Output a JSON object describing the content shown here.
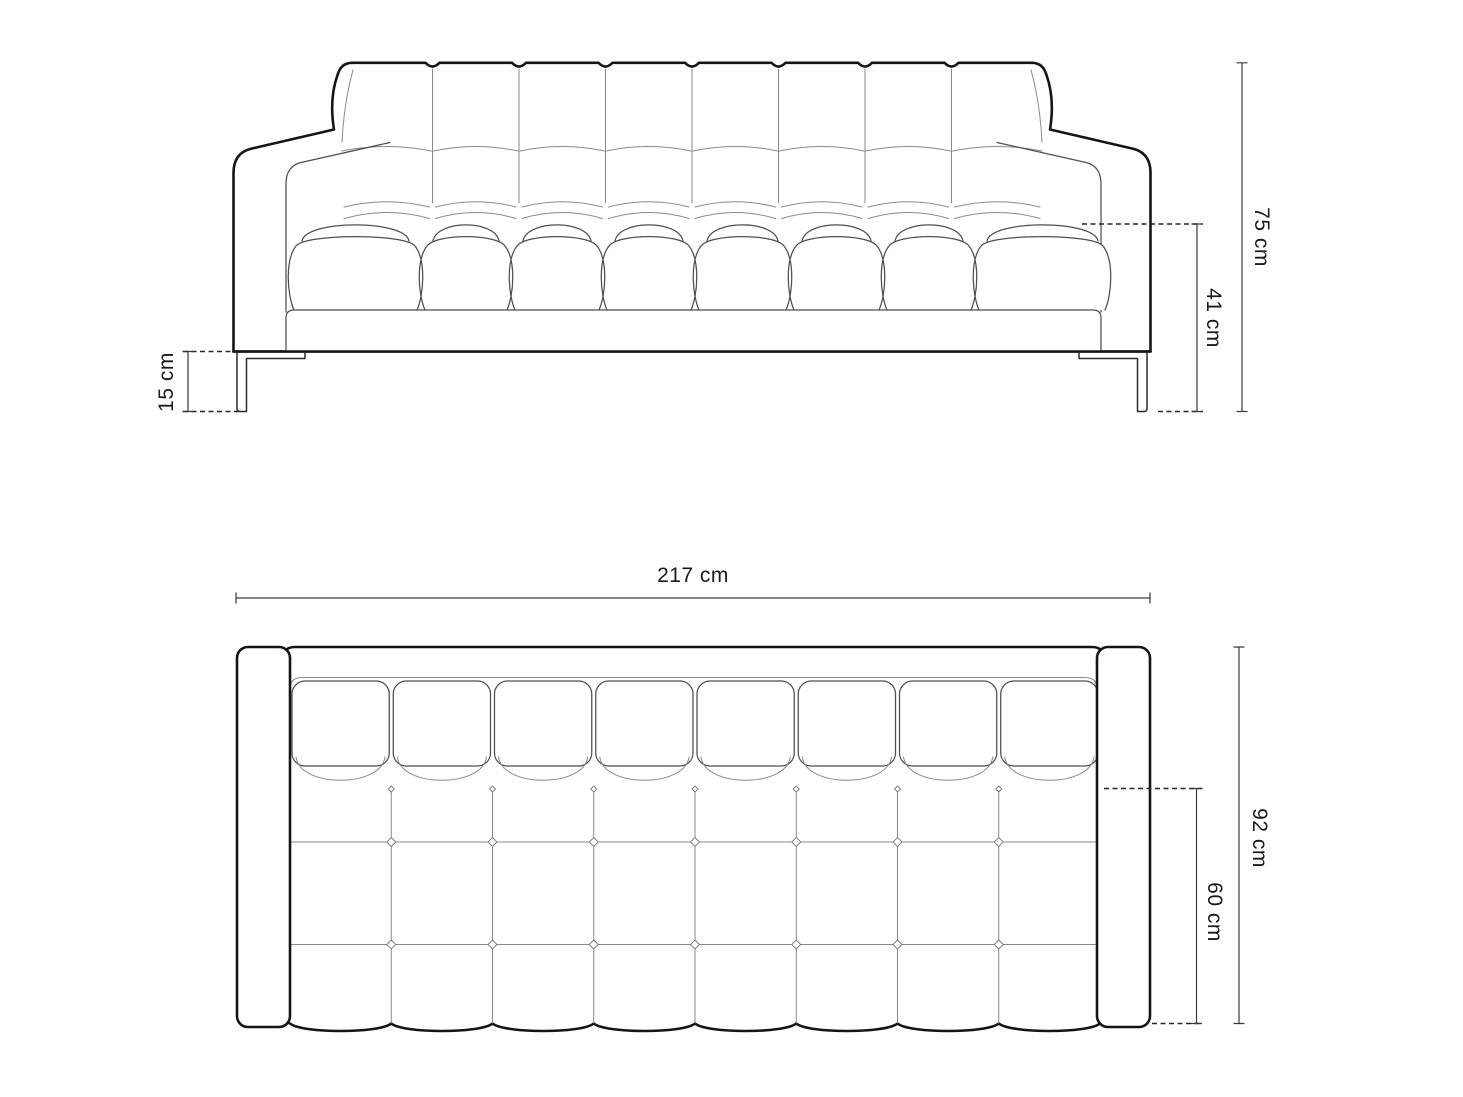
{
  "drawing_title": "sofa technical drawing",
  "dimensions": {
    "front": {
      "overall_height": "75 cm",
      "seat_height": "41 cm",
      "leg_height": "15 cm"
    },
    "top": {
      "overall_width": "217 cm",
      "overall_depth": "92 cm",
      "seat_depth": "60 cm"
    }
  },
  "colors": {
    "background": "#ffffff",
    "outline": "#151515",
    "thin_line": "#8a8a8a",
    "dimension_line": "#3a3a3a"
  }
}
